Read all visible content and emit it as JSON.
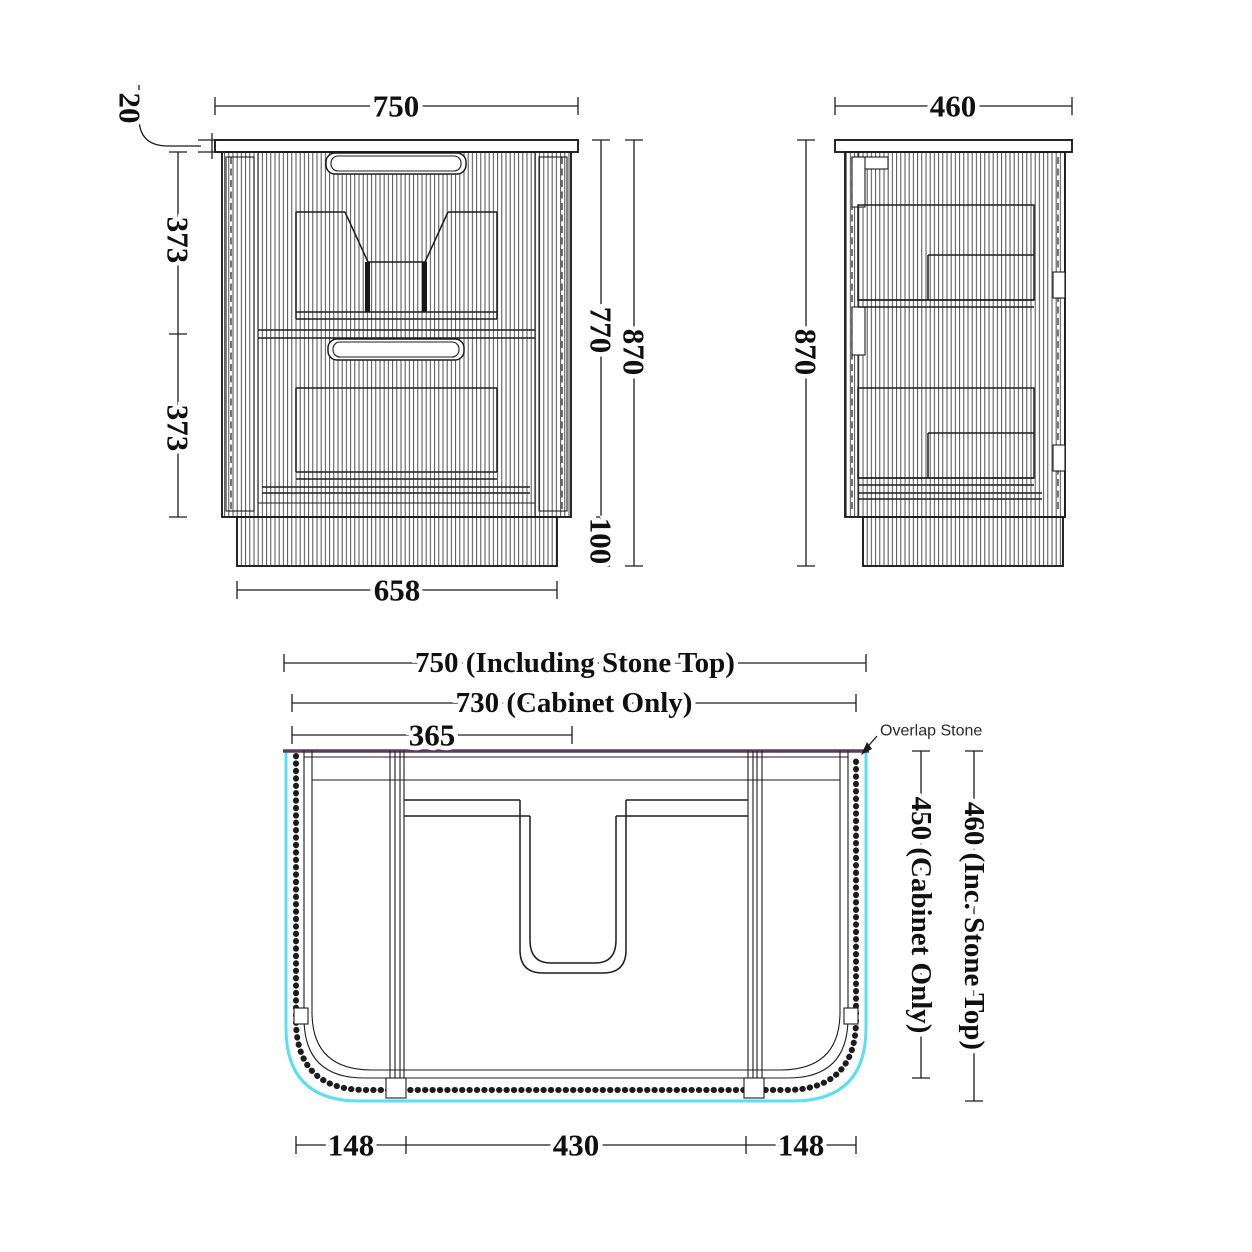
{
  "drawing_title": "Vanity cabinet technical dimension drawing",
  "colors": {
    "line": "#1c1c1c",
    "cyan": "#58dff2",
    "stone_edge": "#5a3c5e"
  },
  "front_view": {
    "width_top": "750",
    "stone_thickness": "20",
    "upper_section": "373",
    "lower_section": "373",
    "body_height": "770",
    "total_height": "870",
    "kick_height": "100",
    "kick_width": "658"
  },
  "side_view": {
    "depth": "460",
    "height": "870"
  },
  "plan_view": {
    "overall_width": "750 (Including Stone Top)",
    "cabinet_width": "730 (Cabinet Only)",
    "half_width": "365",
    "overlap_note": "Overlap Stone",
    "cabinet_depth": "450 (Cabinet Only)",
    "overall_depth": "460 (Inc. Stone Top)",
    "left_offset": "148",
    "center_width": "430",
    "right_offset": "148"
  }
}
